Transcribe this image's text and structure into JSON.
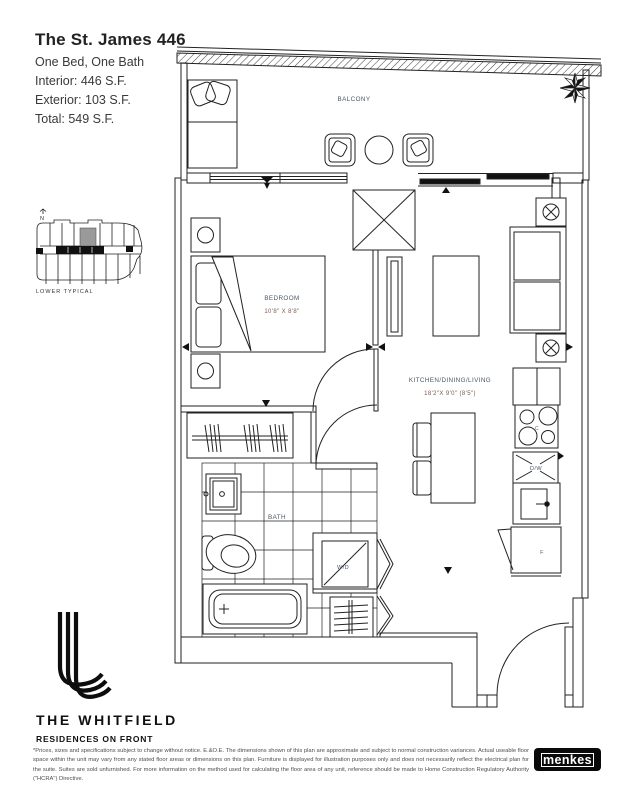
{
  "header": {
    "title": "The St. James 446",
    "subtitle": "One Bed, One Bath",
    "interior": "Interior: 446 S.F.",
    "exterior": "Exterior: 103 S.F.",
    "total": "Total: 549 S.F."
  },
  "keyplan": {
    "north_label": "N",
    "caption": "LOWER TYPICAL"
  },
  "plan": {
    "rooms": {
      "balcony": "BALCONY",
      "bedroom": "BEDROOM",
      "bedroom_dim": "10'8\" X 8'8\"",
      "kitchen": "KITCHEN/DINING/LIVING",
      "kitchen_dim": "18'2\"X 9'0\" (8'5\")",
      "bath": "BATH"
    },
    "appliances": {
      "washer_dryer": "W/D",
      "dishwasher": "D/W",
      "cooktop": "C",
      "fridge": "F"
    }
  },
  "branding": {
    "building_name": "THE WHITFIELD",
    "tagline": "RESIDENCES ON FRONT",
    "developer": "menkes"
  },
  "colors": {
    "linework": "#222222",
    "room_label": "#4a5766",
    "dimension_label": "#7b5a4e",
    "keyplan_highlight": "#9a9a9a",
    "logo_black": "#0a0a0a"
  },
  "disclaimer": "*Prices, sizes and specifications subject to change without notice. E.&O.E. The dimensions shown of this plan are approximate and subject to normal construction variances. Actual useable floor space within the unit may vary from any stated floor areas or dimensions on this plan. Furniture is displayed for illustration purposes only and does not necessarily reflect the electrical plan for the suite. Suites are sold unfurnished. For more information on the method used for calculating the floor area of any unit, reference should be made to Home Construction Regulatory Authority (\"HCRA\") Directive."
}
